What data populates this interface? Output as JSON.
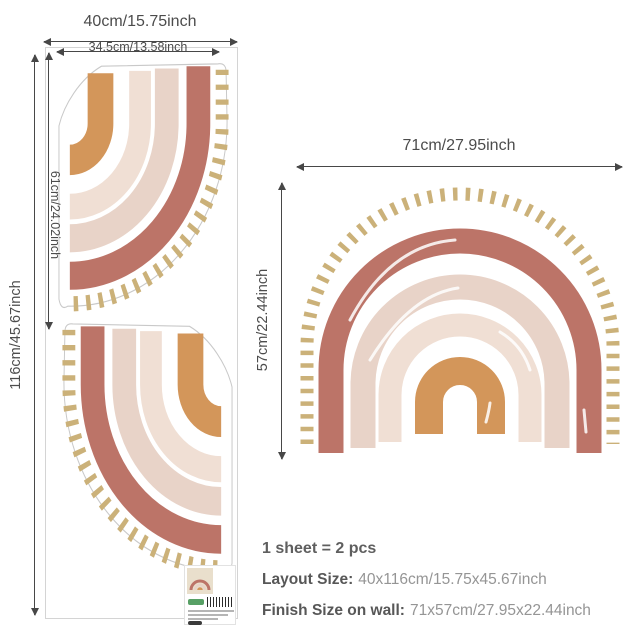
{
  "title_hint": "rainbow wall decal size diagram",
  "colors": {
    "terracotta": "#BC7468",
    "cream_light": "#E8D3C8",
    "cream_lighter": "#F0DFD4",
    "orange": "#D3965A",
    "tan_dash": "#CBB179",
    "outline": "#c9c9c9",
    "dimension_text": "#4c4c4c",
    "brand_green": "#3a8f4a"
  },
  "sheet": {
    "width_label": "40cm/15.75inch",
    "height_label": "116cm/45.67inch",
    "piece": {
      "width_label": "34.5cm/13.58inch",
      "height_label": "61cm/24.02inch"
    }
  },
  "wall": {
    "width_label": "71cm/27.95inch",
    "height_label": "57cm/22.44inch"
  },
  "specs": {
    "sheet_count": "1 sheet = 2 pcs",
    "layout_label": "Layout Size:",
    "layout_value": "40x116cm/15.75x45.67inch",
    "finish_label": "Finish Size on wall:",
    "finish_value": "71x57cm/27.95x22.44inch"
  }
}
